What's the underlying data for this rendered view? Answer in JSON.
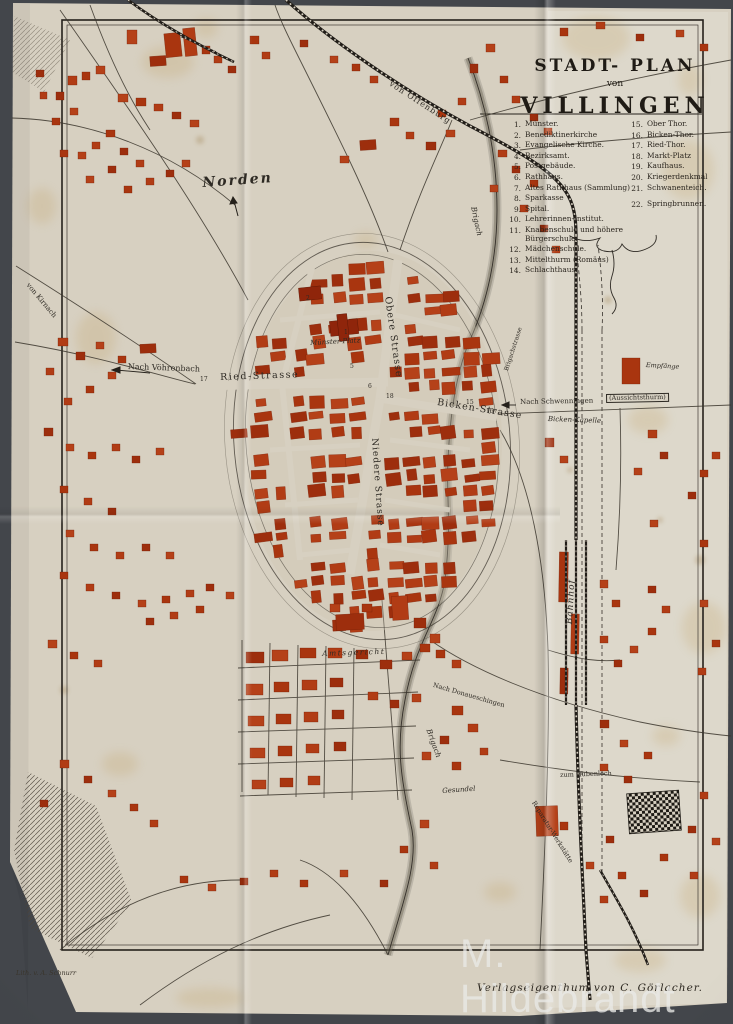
{
  "photo": {
    "watermark": "M. Hildebrandt"
  },
  "title": {
    "line1": "STADT- PLAN",
    "line2": "von",
    "line3": "VILLINGEN"
  },
  "legend": {
    "left": [
      {
        "num": "1.",
        "label": "Münster."
      },
      {
        "num": "2.",
        "label": "Benediktinerkirche"
      },
      {
        "num": "3.",
        "label": "Evangelische Kirche."
      },
      {
        "num": "4.",
        "label": "Bezirksamt."
      },
      {
        "num": "5.",
        "label": "Postgebäude."
      },
      {
        "num": "6.",
        "label": "Rathhaus."
      },
      {
        "num": "7.",
        "label": "Altes Rathhaus (Sammlung)"
      },
      {
        "num": "8.",
        "label": "Sparkasse"
      },
      {
        "num": "9.",
        "label": "Spital."
      },
      {
        "num": "10.",
        "label": "Lehrerinnen-Institut."
      },
      {
        "num": "11.",
        "label": "Knabenschule und höhere Bürgerschule."
      },
      {
        "num": "12.",
        "label": "Mädchenschule."
      },
      {
        "num": "13.",
        "label": "Mittelthurm (Romäus)"
      },
      {
        "num": "14.",
        "label": "Schlachthaus."
      }
    ],
    "right": [
      {
        "num": "15.",
        "label": "Ober Thor."
      },
      {
        "num": "16.",
        "label": "Bicken-Thor."
      },
      {
        "num": "17.",
        "label": "Ried-Thor."
      },
      {
        "num": "18.",
        "label": "Markt-Platz"
      },
      {
        "num": "19.",
        "label": "Kaufhaus."
      },
      {
        "num": "20.",
        "label": "Kriegerdenkmal"
      },
      {
        "num": "21.",
        "label": "Schwanenteich."
      },
      {
        "num": "22.",
        "label": "Springbrunnen."
      }
    ]
  },
  "map_labels": {
    "norden": "Norden",
    "von_offenburg": "von Offenburg",
    "von_kirnach": "von Kirnach",
    "nach_voehrenbach": "Nach Vöhrenbach",
    "ried_strasse": "Ried-Strasse",
    "obere_strasse": "Obere Strasse",
    "niedere_strasse": "Niedere Strasse",
    "bicken_strasse": "Bicken-Strasse",
    "muenster_platz": "Münster-Platz",
    "brigach_upper": "Brigach",
    "brigach_lower": "Brigach",
    "nach_schwenningen": "Nach Schwenningen",
    "aussichtsthurm": "(Aussichtsthurm)",
    "bicken_kapelle": "Bicken-Kapelle",
    "empfaenge": "Empfänge",
    "bahnhof": "Bahnhof",
    "amtsgericht": "Amtsgericht",
    "nach_donaueschingen": "Nach Donaueschingen",
    "reparatur_werkstaette": "Reparatur-Werkstätte",
    "zum_hubenloch": "zum Hubenloch",
    "gesundel": "Gesundel",
    "brigachstrasse": "Brigachstrasse"
  },
  "map_numbers": {
    "n1": "1",
    "n2": "2",
    "n5": "5",
    "n6": "6",
    "n15": "15",
    "n16": "16",
    "n17": "17",
    "n18": "18"
  },
  "credits": {
    "lithographer": "Lith. v. A. Schnurr",
    "publisher": "Verlagseigenthum von C. Görlacher."
  },
  "colors": {
    "paper": "#d7d0c1",
    "ink": "#2e2a24",
    "building_red": "#a9350f",
    "background": "#43464b"
  }
}
